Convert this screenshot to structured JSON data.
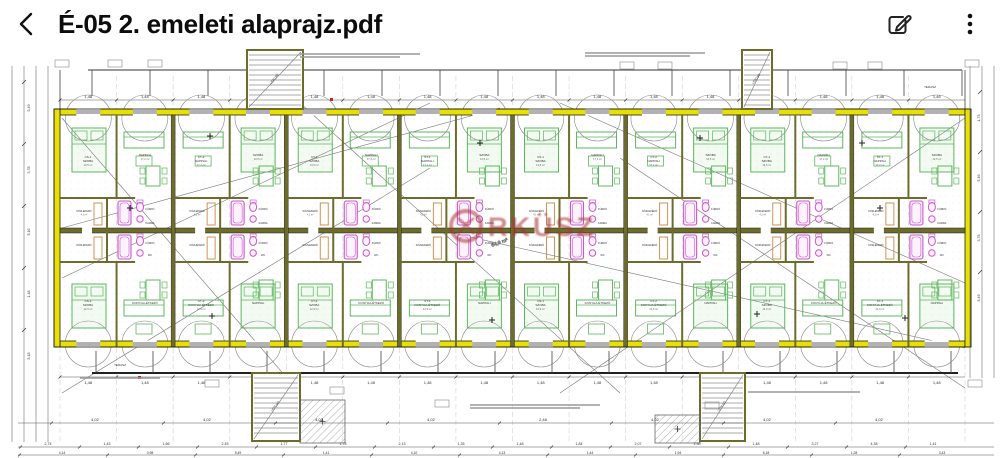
{
  "header": {
    "title": "É-05 2. emeleti alaprajz.pdf",
    "back_icon": "chevron-left",
    "edit_icon": "edit-pencil-square",
    "menu_icon": "kebab-menu"
  },
  "colors": {
    "exterior_wall_yellow": "#e8e000",
    "interior_wall_olive": "#6d6d2b",
    "furniture_green": "#5cb85c",
    "fixture_pink": "#cc55cc",
    "fixture_orange": "#cc8844",
    "line_dark": "#222222",
    "line_gray": "#777777",
    "dim_text": "#444444",
    "watermark_red": "#a83232",
    "accent_red": "#cc2222"
  },
  "floorplan": {
    "watermark_text": "RKÜSZ",
    "rooms": {
      "szoba": "SZOBA",
      "nappali": "NAPPALI",
      "kozlekedo": "KÖZLEKEDŐ",
      "furdo": "FÜRDŐ",
      "kamra": "KAMRA",
      "konyha": "KONYHA-ÉTKEZŐ",
      "wc": "WC",
      "terasz": "TERASZ",
      "lepcso": "LÉPCSŐ"
    },
    "unit_codes": [
      "CS-1",
      "CT-2",
      "CT-1",
      "ST-1"
    ],
    "areas": [
      "13,5 m²",
      "17,2 m²",
      "4,1 m²",
      "1,5 m²",
      "12,9 m²"
    ],
    "diagonal_area": "64,9 m²",
    "window_dim": "1,48",
    "bottom_dims_row1": [
      "4,02",
      "4,02",
      "4,02",
      "4,02",
      "2,48",
      "4,02",
      "4,02",
      "4,02"
    ],
    "bottom_dims_row2": [
      "2,74",
      "1,43",
      "1,66",
      "2,45",
      "1,77",
      "1,75",
      "2,13",
      "1,35",
      "1,48",
      "1,84",
      "2,07",
      "1,30",
      "1,48",
      "3,27",
      "4,38",
      "1,41"
    ],
    "bottom_dims_row3": [
      "4,14",
      "0,98",
      "5,49",
      "1,41",
      "4,10",
      "4,13",
      "1,44",
      "1,94",
      "6,18",
      "1,28",
      "3,43"
    ],
    "left_dims": [
      "5,49",
      "3,78",
      "5,16",
      "1,48",
      "5,18"
    ],
    "right_dims": [
      "1,73",
      "5,16",
      "3,78",
      "5,49"
    ]
  }
}
